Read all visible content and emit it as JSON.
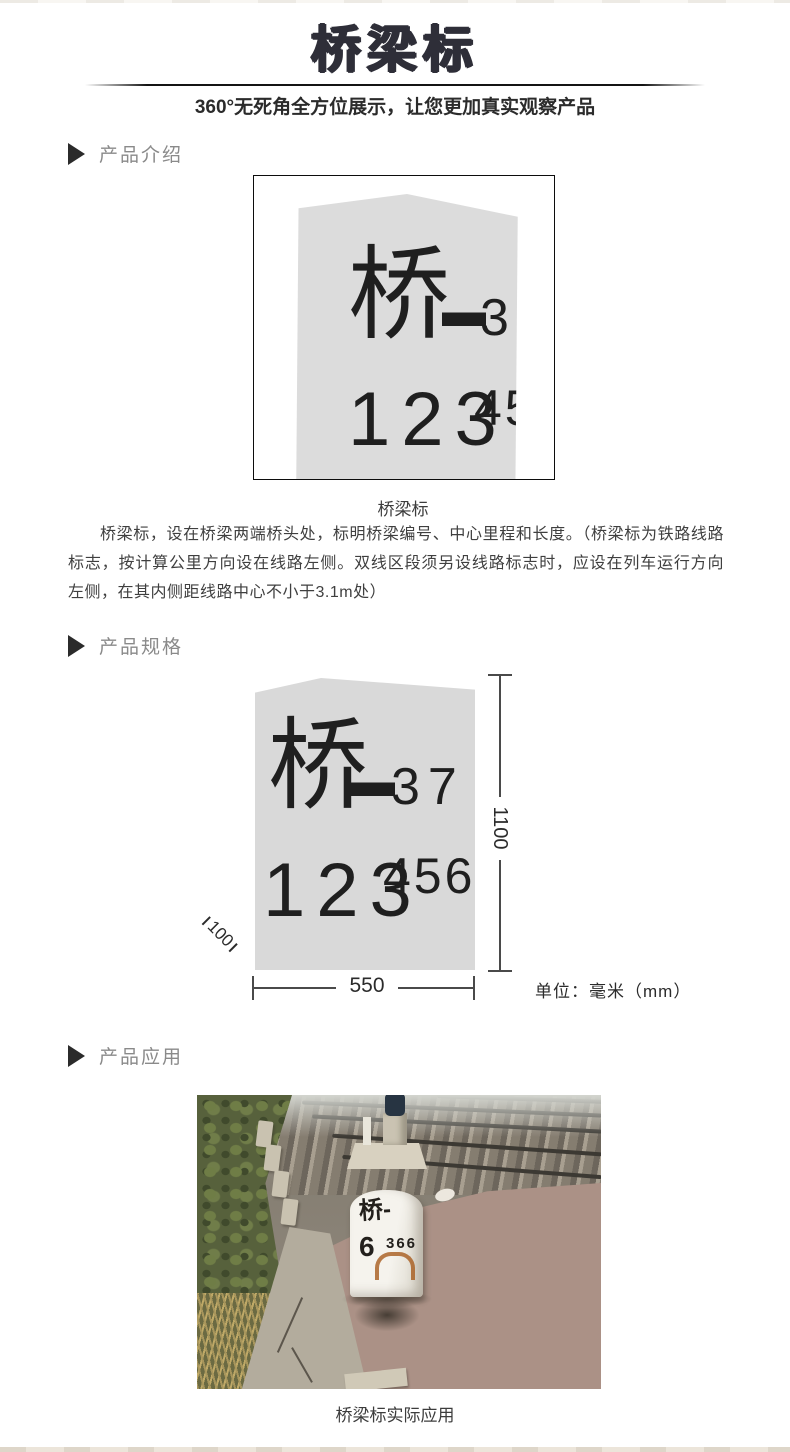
{
  "header": {
    "title": "桥梁标",
    "subtitle": "360°无死角全方位展示，让您更加真实观察产品"
  },
  "sections": {
    "intro_label": "产品介绍",
    "spec_label": "产品规格",
    "app_label": "产品应用"
  },
  "marker_face": {
    "prefix": "桥",
    "dash": "—",
    "serial": "37",
    "mileage_big": "123",
    "mileage_small": "456"
  },
  "intro": {
    "caption": "桥梁标",
    "description": "桥梁标，设在桥梁两端桥头处，标明桥梁编号、中心里程和长度。（桥梁标为铁路线路标志，按计算公里方向设在线路左侧。双线区段须另设线路标志时，应设在列车运行方向左侧，在其内侧距线路中心不小于3.1m处）"
  },
  "spec": {
    "height_mm": "1100",
    "width_mm": "550",
    "depth_mm": "100",
    "unit": "单位：毫米（mm）"
  },
  "application": {
    "caption": "桥梁标实际应用",
    "photo_marker": {
      "line1": "桥-",
      "num_big": "6",
      "num_small": "366"
    }
  },
  "colors": {
    "title": "#2e2e38",
    "section_label": "#8a8a8a",
    "marker_fill": "#dcdcdc",
    "marker_text": "#1f1f1f",
    "dim_line": "#4a4a4a"
  }
}
